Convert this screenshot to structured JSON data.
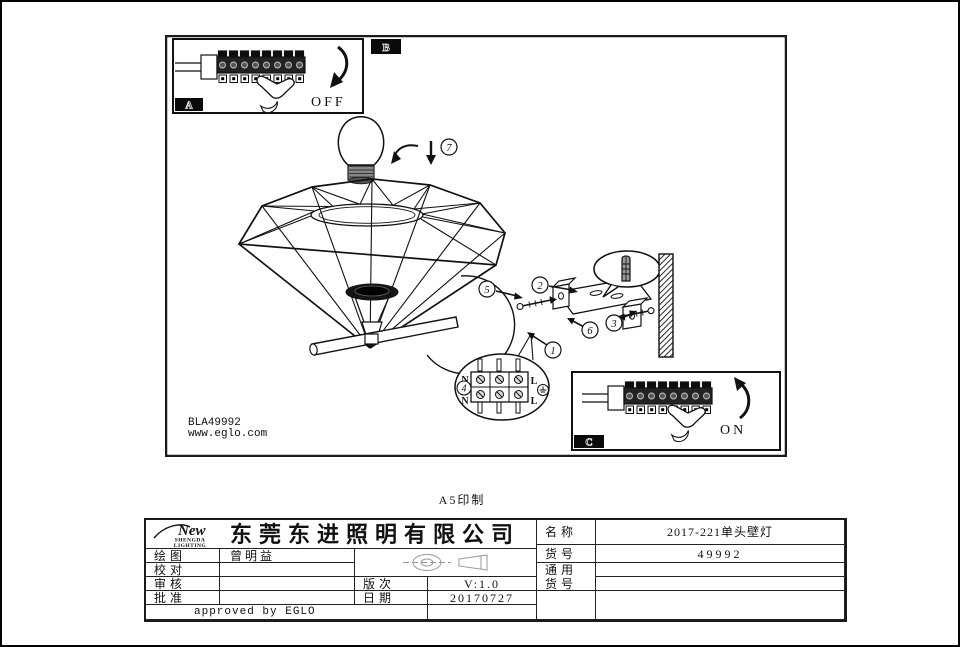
{
  "page": {
    "print_note": "A5印制"
  },
  "drawing": {
    "product_code": "BLA49992",
    "website": "www.eglo.com",
    "step_labels": {
      "off": "OFF",
      "on": "ON"
    },
    "section_labels": {
      "a": "A",
      "b": "B",
      "c": "C"
    },
    "part_numbers": [
      "1",
      "2",
      "3",
      "4",
      "5",
      "6",
      "7"
    ],
    "wiring": {
      "neutral": "N",
      "live": "L"
    },
    "colors": {
      "line": "#111111",
      "paper": "#ffffff"
    }
  },
  "title_block": {
    "logo": {
      "script": "New",
      "caption1": "SHENGDA",
      "caption2": "LIGHTING"
    },
    "company": "东莞东进照明有限公司",
    "fields": {
      "draw_label": "绘图",
      "draw_value": "曾明益",
      "check_label": "校对",
      "check_value": "",
      "review_label": "审核",
      "review_value": "",
      "approve_label": "批准",
      "approve_value": "",
      "version_label": "版次",
      "version_value": "V:1.0",
      "date_label": "日期",
      "date_value": "20170727",
      "approved_note": "approved by EGLO",
      "name_label": "名称",
      "name_value": "2017-221单头壁灯",
      "sku_label": "货号",
      "sku_value": "49992",
      "generic_line1": "通用",
      "generic_line2": "货号"
    }
  }
}
